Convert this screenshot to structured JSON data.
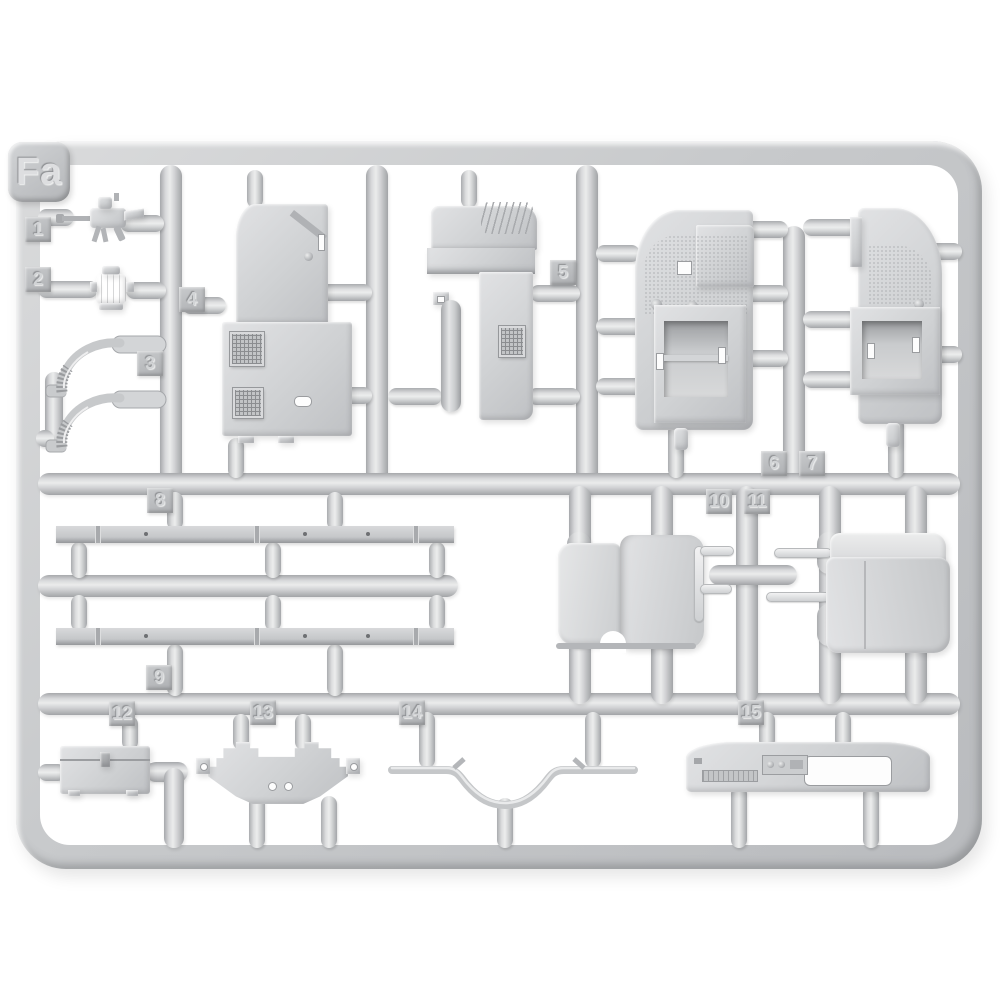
{
  "scene": {
    "type": "photo of a light-grey injection-moulded model kit sprue on white background",
    "background_color": "#ffffff",
    "plastic_color": "#cbcdcf",
    "plastic_highlight": "#ebecec",
    "plastic_shadow": "#a2a4a7"
  },
  "sprue": {
    "frame_label": "Fa",
    "part_tabs": [
      "1",
      "2",
      "3",
      "4",
      "5",
      "6",
      "7",
      "8",
      "9",
      "10",
      "11",
      "12",
      "13",
      "14",
      "15"
    ],
    "parts": [
      {
        "tab": "1",
        "shape": "small machine-gun"
      },
      {
        "tab": "2",
        "shape": "small cylindrical fitting"
      },
      {
        "tab": "3",
        "shape": "two curved ribbed pipes"
      },
      {
        "tab": "4",
        "shape": "cab bulkhead panel with two mesh grilles"
      },
      {
        "tab": "5",
        "shape": "cab cowl side panel with mesh grille"
      },
      {
        "tab": "6",
        "shape": "door interior panel with stowage box"
      },
      {
        "tab": "7",
        "shape": "door interior panel with stowage box, mirrored"
      },
      {
        "tab": "8",
        "shape": "long flat rail strip"
      },
      {
        "tab": "9",
        "shape": "long flat rail strip"
      },
      {
        "tab": "10",
        "shape": "bench seat"
      },
      {
        "tab": "11",
        "shape": "bench seat"
      },
      {
        "tab": "12",
        "shape": "tool box"
      },
      {
        "tab": "13",
        "shape": "mounting bracket plate"
      },
      {
        "tab": "14",
        "shape": "curved rod"
      },
      {
        "tab": "15",
        "shape": "dashboard panel with window cut-out"
      }
    ]
  }
}
